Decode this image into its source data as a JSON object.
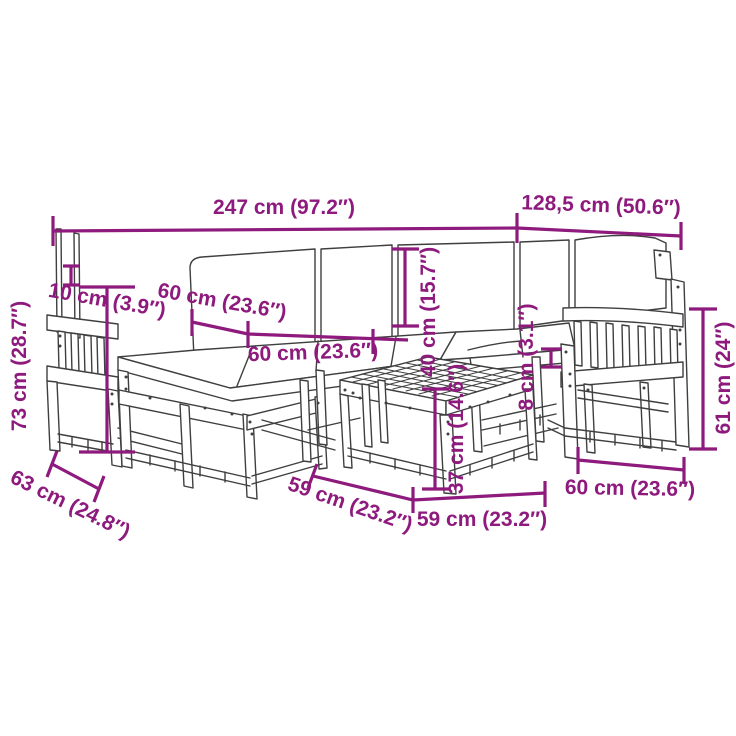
{
  "diagram": {
    "type": "furniture-dimension-diagram",
    "subject": "garden-sofa-set-with-table",
    "colors": {
      "dimension": "#8D1A7C",
      "outline": "#3F3F3F",
      "background": "#FFFFFF"
    },
    "dimensions": [
      {
        "name": "total-length",
        "text": "247 cm (97.2″)"
      },
      {
        "name": "right-section-length",
        "text": "128,5 cm (50.6″)"
      },
      {
        "name": "back-cushion-height",
        "text": "10 cm (3.9″)"
      },
      {
        "name": "seat-depth",
        "text": "60 cm (23.6″)"
      },
      {
        "name": "seat-width",
        "text": "60 cm (23.6″)"
      },
      {
        "name": "backrest-height",
        "text": "40 cm (15.7″)"
      },
      {
        "name": "seat-cushion-thickness",
        "text": "8 cm (3.1″)"
      },
      {
        "name": "table-height",
        "text": "37 cm (14.6″)"
      },
      {
        "name": "overall-height",
        "text": "73 cm (28.7″)"
      },
      {
        "name": "module-depth",
        "text": "63 cm (24.8″)"
      },
      {
        "name": "table-depth",
        "text": "59 cm (23.2″)"
      },
      {
        "name": "table-width",
        "text": "59 cm (23.2″)"
      },
      {
        "name": "armchair-width",
        "text": "60 cm (23.6″)"
      },
      {
        "name": "armrest-height",
        "text": "61 cm (24″)"
      }
    ]
  }
}
